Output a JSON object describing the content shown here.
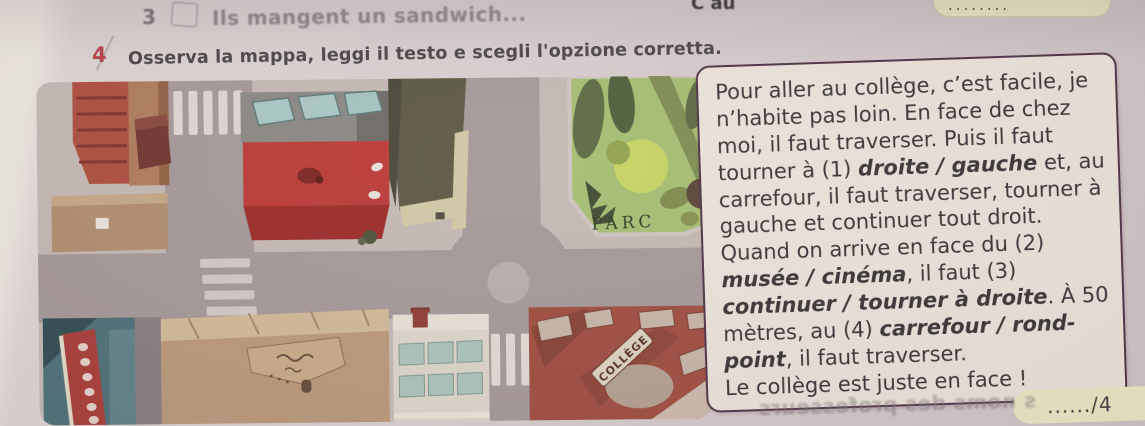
{
  "prev_exercise": {
    "number": "3",
    "text": "Ils mangent un sandwich..."
  },
  "top_fragments": {
    "left_text": "C au",
    "right_badge_dots": "........"
  },
  "exercise": {
    "number": "4",
    "instruction": "Osserva la mappa, leggi il testo e scegli l'opzione corretta."
  },
  "map": {
    "labels": {
      "parc": "PARC",
      "college": "COLLÈGE"
    }
  },
  "passage": {
    "segments": [
      {
        "text": "Pour aller au collège, c’est facile, je n’habite pas loin. En face de chez moi, il faut traverser. Puis il faut tourner à (1) ",
        "bold": false
      },
      {
        "text": "droite / gauche",
        "bold": true
      },
      {
        "text": " et, au carrefour, il faut traverser, tourner à gauche et continuer tout droit. Quand on arrive en face du (2) ",
        "bold": false
      },
      {
        "text": "musée / cinéma",
        "bold": true
      },
      {
        "text": ", il faut (3) ",
        "bold": false
      },
      {
        "text": "continuer / tourner à droite",
        "bold": true
      },
      {
        "text": ". À 50 mètres, au (4) ",
        "bold": false
      },
      {
        "text": "carrefour / rond-point",
        "bold": true
      },
      {
        "text": ", il faut traverser.\nLe collège est juste en face !",
        "bold": false
      }
    ]
  },
  "score_badge": "....../4",
  "showthrough_text": "s noms des professeurs",
  "colors": {
    "paper": "#d7cdce",
    "accent-red": "#b5434a",
    "box-border": "#4e3546",
    "box-bg": "#eae2da",
    "badge-bg": "#ebe6c4",
    "sidewalk": "#c6b7b3",
    "road": "#a79798",
    "park-green": "#a2bf63",
    "bright-red": "#d13430",
    "college-red": "#ad4a3a",
    "teal-bldg": "#48737b",
    "museum-tan": "#c09872",
    "white-bldg": "#dcd5c7",
    "khaki": "#5d5840"
  }
}
